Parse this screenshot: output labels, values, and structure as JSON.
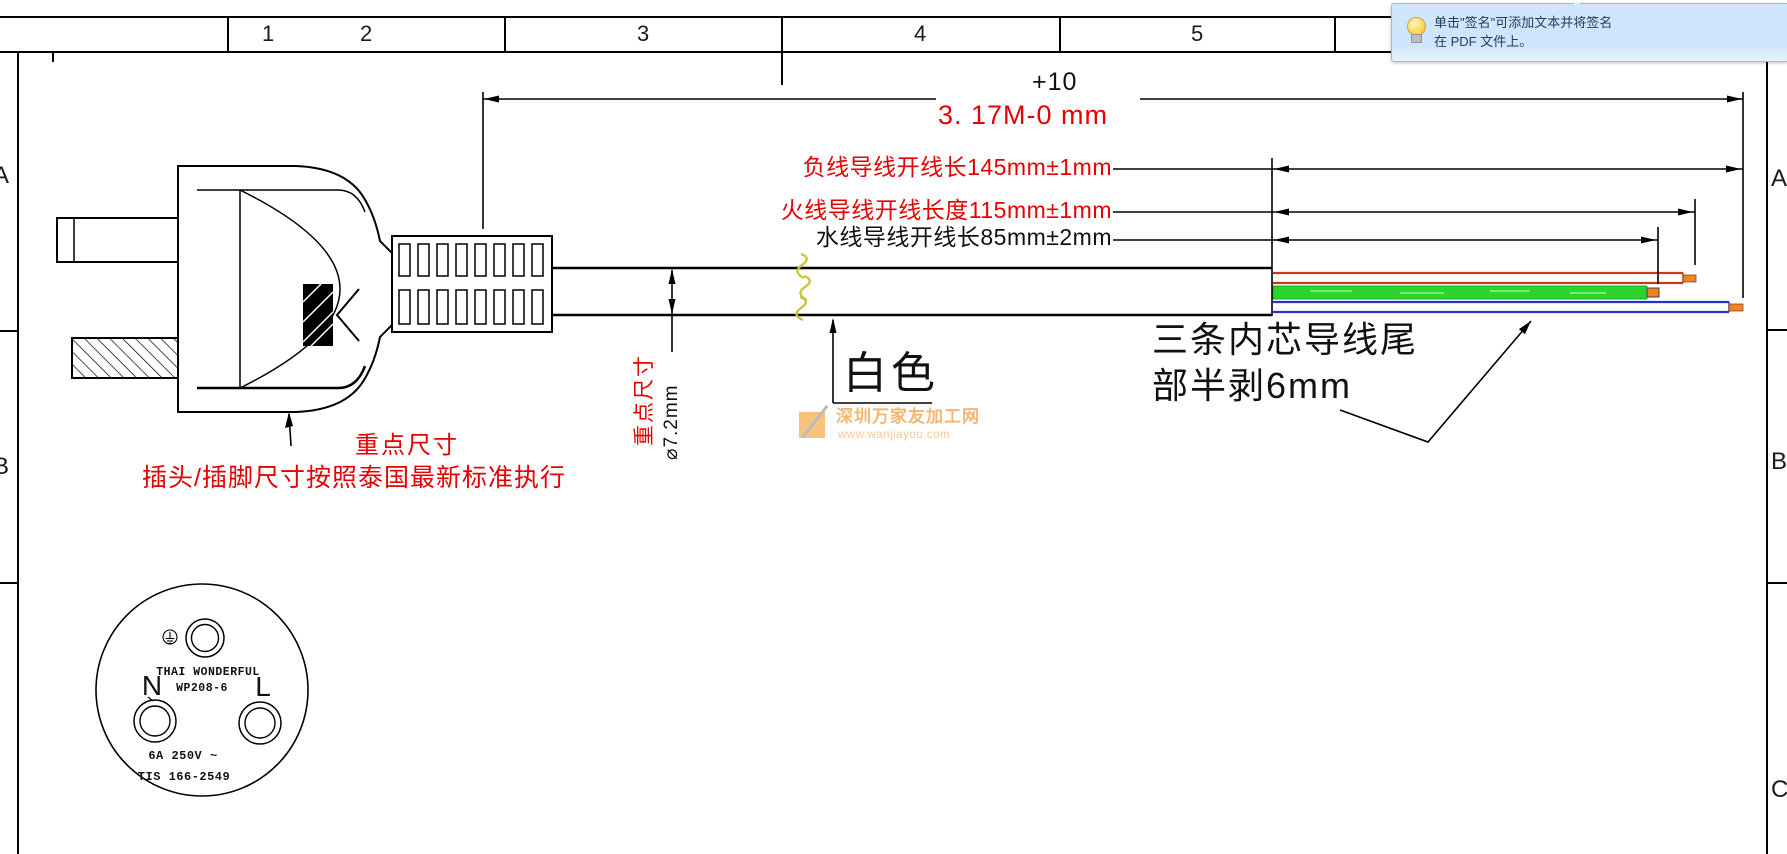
{
  "tooltip": {
    "chevron": "ˆ",
    "line1": "单击\"签名\"可添加文本并将签名",
    "line2": "在 PDF 文件上。"
  },
  "frame": {
    "columns": [
      "1",
      "2",
      "3",
      "4",
      "5"
    ],
    "rows_left": [
      "A",
      "B"
    ],
    "rows_right": [
      "A",
      "B",
      "C"
    ]
  },
  "total_dim": {
    "tol_plus": "+10",
    "text": "3. 17M-0  mm"
  },
  "wire_notes": {
    "neutral": "负线导线开线长145mm±1mm",
    "live": "火线导线开线长度115mm±1mm",
    "water": "水线导线开线长85mm±2mm"
  },
  "cable": {
    "key_note": "重点尺寸",
    "diameter_note": "⌀7.2mm",
    "color_label": "白色"
  },
  "strip_note": {
    "line1": "三条内芯导线尾",
    "line2": "部半剥6mm"
  },
  "plug_note": {
    "key": "重点尺寸",
    "standard": "插头/插脚尺寸按照泰国最新标准执行"
  },
  "plug_face": {
    "brand": "THAI WONDERFUL",
    "model": "WP208-6",
    "neutral": "N",
    "live": "L",
    "rating": "6A 250V ~",
    "standard": "TIS 166-2549"
  },
  "watermark": {
    "name": "深圳万家友加工网",
    "url": "www.wanjiayou.com"
  },
  "colors": {
    "red": "#e60000",
    "wire_brown": "#c43b17",
    "wire_green": "#2cd42c",
    "wire_blue": "#2330cf",
    "bare_tip": "#ef8424",
    "watermark": "#f0a24a",
    "tooltip_bg": "#cfe5fb",
    "squiggle": "#d4c93e"
  }
}
